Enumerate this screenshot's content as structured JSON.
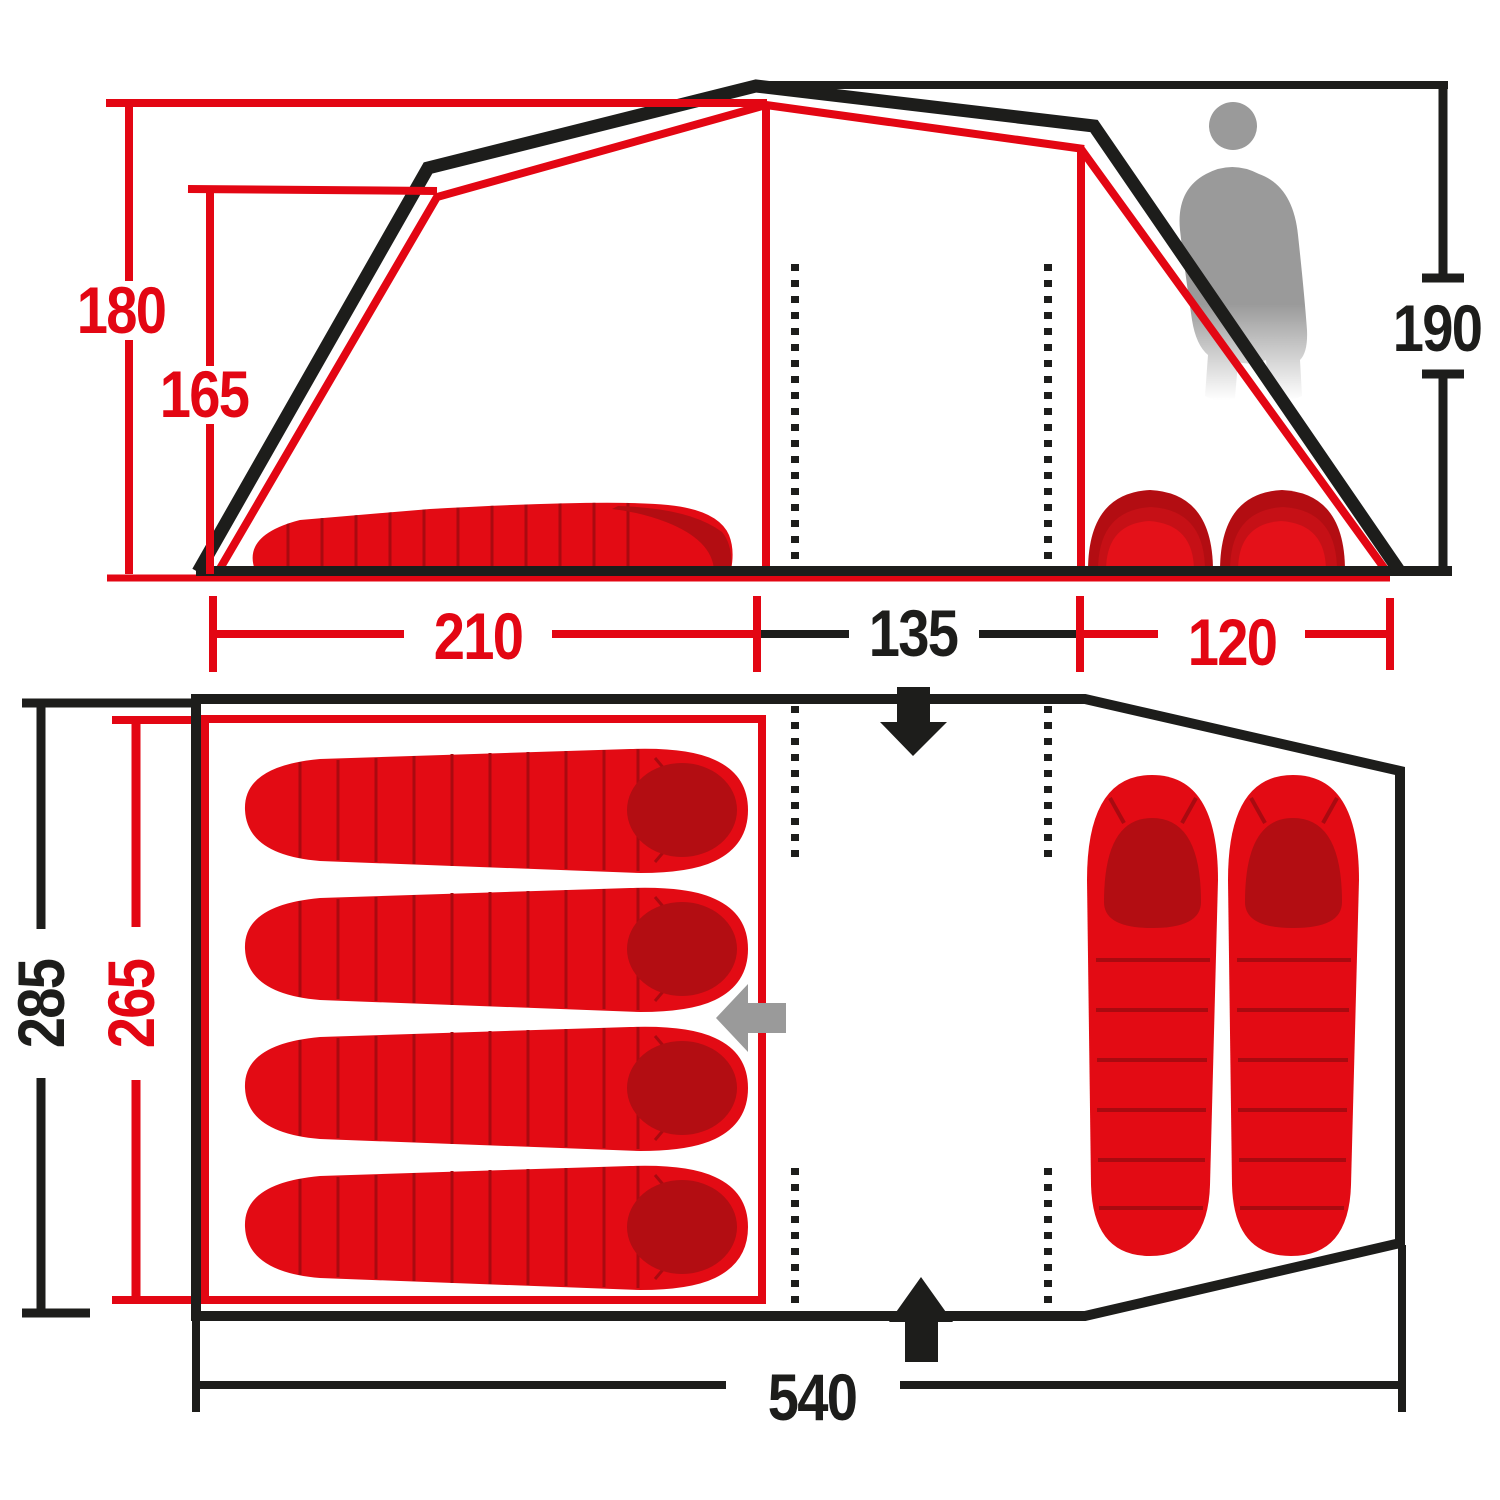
{
  "colors": {
    "accent_red": "#e30613",
    "dark_red": "#b30d12",
    "line_black": "#1d1d1b",
    "silhouette_gray": "#9a9a9a"
  },
  "side_view": {
    "height_inner_peak": "180",
    "height_inner_shoulder": "165",
    "height_outer": "190",
    "width_left_cabin": "210",
    "width_center": "135",
    "width_right_cabin": "120"
  },
  "floor_plan": {
    "depth_outer": "285",
    "depth_inner_cabin": "265",
    "length_total": "540"
  },
  "counts": {
    "sleeping_bags_left_cabin": 4,
    "sleeping_bags_right_cabin": 2,
    "sleeping_mats_side_view": 2
  }
}
